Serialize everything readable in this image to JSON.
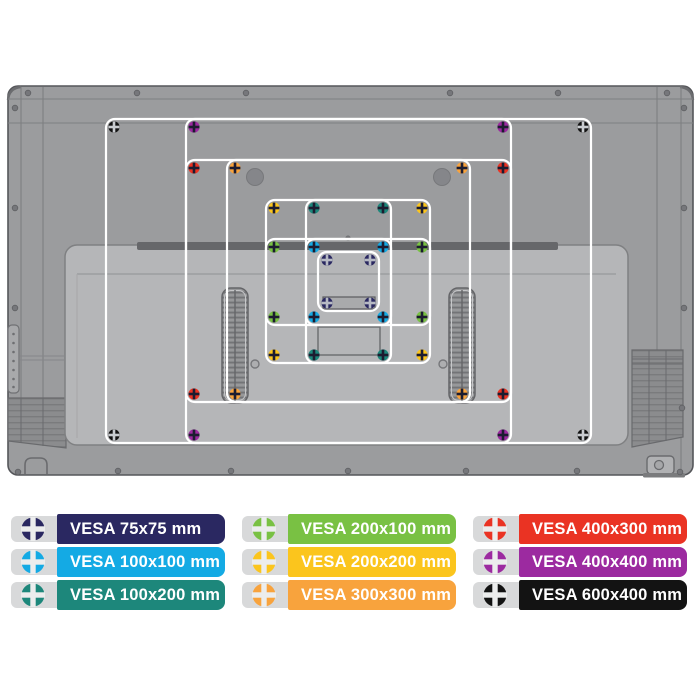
{
  "page": {
    "background": "#ffffff"
  },
  "diagram": {
    "description": "Rear view of a flat-screen TV with nine overlaid VESA mounting-hole patterns",
    "chassis_colors": {
      "tv_back": "#9b9c9e",
      "tv_border": "#55565a",
      "seam": "#7e7f81",
      "lower_panel": "#b5b6b8",
      "lower_panel_border": "#7f8082",
      "shadow_bar": "#66676a",
      "vent": "#8b8c8e",
      "vesa_outline": "#ffffff"
    },
    "vesa_patterns": [
      {
        "size": "600x400",
        "label": "VESA 600x400 mm",
        "color": "#131313",
        "cross": "#c9ccd0",
        "rect": {
          "x": 106,
          "y": 119,
          "w": 485,
          "h": 324
        },
        "screws": [
          [
            114,
            127
          ],
          [
            583,
            127
          ],
          [
            114,
            435
          ],
          [
            583,
            435
          ]
        ]
      },
      {
        "size": "400x400",
        "label": "VESA 400x400 mm",
        "color": "#9c2aa0",
        "cross": "#1c1c30",
        "rect": {
          "x": 186,
          "y": 119,
          "w": 325,
          "h": 324
        },
        "screws": [
          [
            194,
            127
          ],
          [
            503,
            127
          ],
          [
            194,
            435
          ],
          [
            503,
            435
          ]
        ]
      },
      {
        "size": "400x300",
        "label": "VESA 400x300 mm",
        "color": "#ea3323",
        "cross": "#1c1c30",
        "rect": {
          "x": 186,
          "y": 160,
          "w": 325,
          "h": 242
        },
        "screws": [
          [
            194,
            168
          ],
          [
            503,
            168
          ],
          [
            194,
            394
          ],
          [
            503,
            394
          ]
        ]
      },
      {
        "size": "300x300",
        "label": "VESA 300x300 mm",
        "color": "#f8a33d",
        "cross": "#1c1c30",
        "rect": {
          "x": 227,
          "y": 160,
          "w": 243,
          "h": 242
        },
        "screws": [
          [
            235,
            168
          ],
          [
            462,
            168
          ],
          [
            235,
            394
          ],
          [
            462,
            394
          ]
        ]
      },
      {
        "size": "200x200",
        "label": "VESA 200x200 mm",
        "color": "#fbc51d",
        "cross": "#1c1c30",
        "rect": {
          "x": 266,
          "y": 200,
          "w": 164,
          "h": 163
        },
        "screws": [
          [
            274,
            208
          ],
          [
            422,
            208
          ],
          [
            274,
            355
          ],
          [
            422,
            355
          ]
        ]
      },
      {
        "size": "100x200",
        "label": "VESA 100x200 mm",
        "color": "#1d877b",
        "cross": "#1c1c30",
        "rect": {
          "x": 306,
          "y": 200,
          "w": 85,
          "h": 163
        },
        "screws": [
          [
            314,
            208
          ],
          [
            383,
            208
          ],
          [
            314,
            355
          ],
          [
            383,
            355
          ]
        ]
      },
      {
        "size": "200x100",
        "label": "VESA 200x100 mm",
        "color": "#79c143",
        "cross": "#1c1c30",
        "rect": {
          "x": 266,
          "y": 239,
          "w": 164,
          "h": 86
        },
        "screws": [
          [
            274,
            247
          ],
          [
            422,
            247
          ],
          [
            274,
            317
          ],
          [
            422,
            317
          ]
        ]
      },
      {
        "size": "100x100",
        "label": "VESA 100x100 mm",
        "color": "#14aae4",
        "cross": "#1c1c30",
        "rect": {
          "x": 306,
          "y": 239,
          "w": 85,
          "h": 86
        },
        "screws": [
          [
            314,
            247
          ],
          [
            383,
            247
          ],
          [
            314,
            317
          ],
          [
            383,
            317
          ]
        ]
      },
      {
        "size": "75x75",
        "label": "VESA 75x75 mm",
        "color": "#2a2861",
        "cross": "#b7bac4",
        "rect": {
          "x": 318,
          "y": 252,
          "w": 61,
          "h": 59
        },
        "screws": [
          [
            327,
            260
          ],
          [
            370,
            260
          ],
          [
            327,
            303
          ],
          [
            370,
            303
          ]
        ]
      }
    ]
  },
  "legend": {
    "icon": "screw-cross-icon",
    "icon_cross_color": "#eceded",
    "pill_color": "#d8d9da",
    "items": [
      {
        "label": "VESA 75x75 mm",
        "color": "#2a2861",
        "size": "75x75"
      },
      {
        "label": "VESA 100x100 mm",
        "color": "#14aae4",
        "size": "100x100"
      },
      {
        "label": "VESA 100x200 mm",
        "color": "#1d877b",
        "size": "100x200"
      },
      {
        "label": "VESA 200x100 mm",
        "color": "#79c143",
        "size": "200x100"
      },
      {
        "label": "VESA 200x200 mm",
        "color": "#fbc51d",
        "size": "200x200"
      },
      {
        "label": "VESA 300x300 mm",
        "color": "#f8a33d",
        "size": "300x300"
      },
      {
        "label": "VESA 400x300 mm",
        "color": "#ea3323",
        "size": "400x300"
      },
      {
        "label": "VESA 400x400 mm",
        "color": "#9c2aa0",
        "size": "400x400"
      },
      {
        "label": "VESA 600x400 mm",
        "color": "#131313",
        "size": "600x400"
      }
    ]
  }
}
